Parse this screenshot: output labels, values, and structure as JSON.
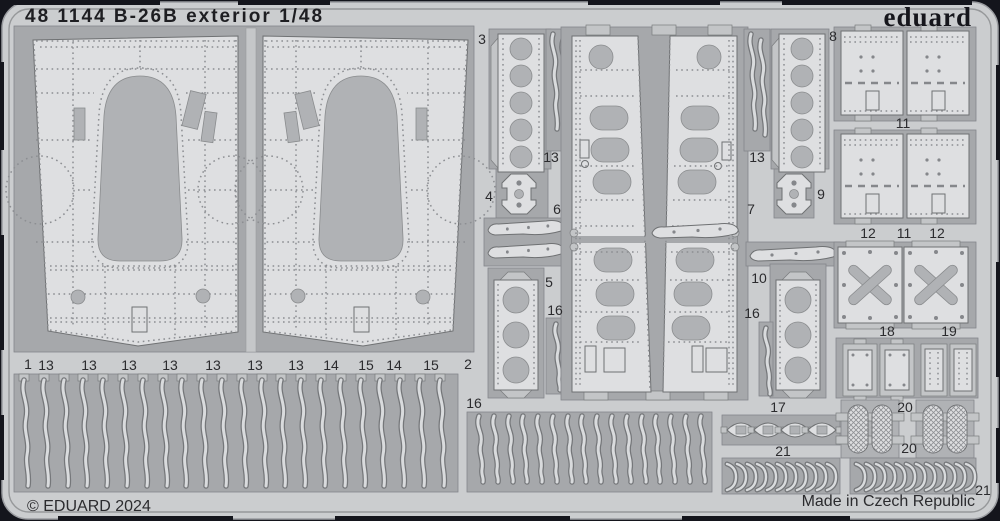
{
  "header": {
    "title": "48 1144 B-26B exterior 1/48",
    "brand": "eduard"
  },
  "footer": {
    "copyright": "© EDUARD 2024",
    "made_in": "Made in Czech Republic"
  },
  "part_labels": [
    "1",
    "13",
    "13",
    "13",
    "13",
    "13",
    "13",
    "13",
    "14",
    "15",
    "14",
    "15",
    "2",
    "3",
    "4",
    "13",
    "6",
    "5",
    "16",
    "16",
    "13",
    "7",
    "8",
    "9",
    "10",
    "16",
    "17",
    "21",
    "11",
    "12",
    "11",
    "12",
    "18",
    "19",
    "20",
    "20",
    "21"
  ],
  "colors": {
    "background": "#14151c",
    "sheet": "#cbcdcf",
    "pocket": "#a6a8ab",
    "part": "#dedfe1",
    "outline": "#6f7173",
    "text": "#2b2b2e"
  }
}
